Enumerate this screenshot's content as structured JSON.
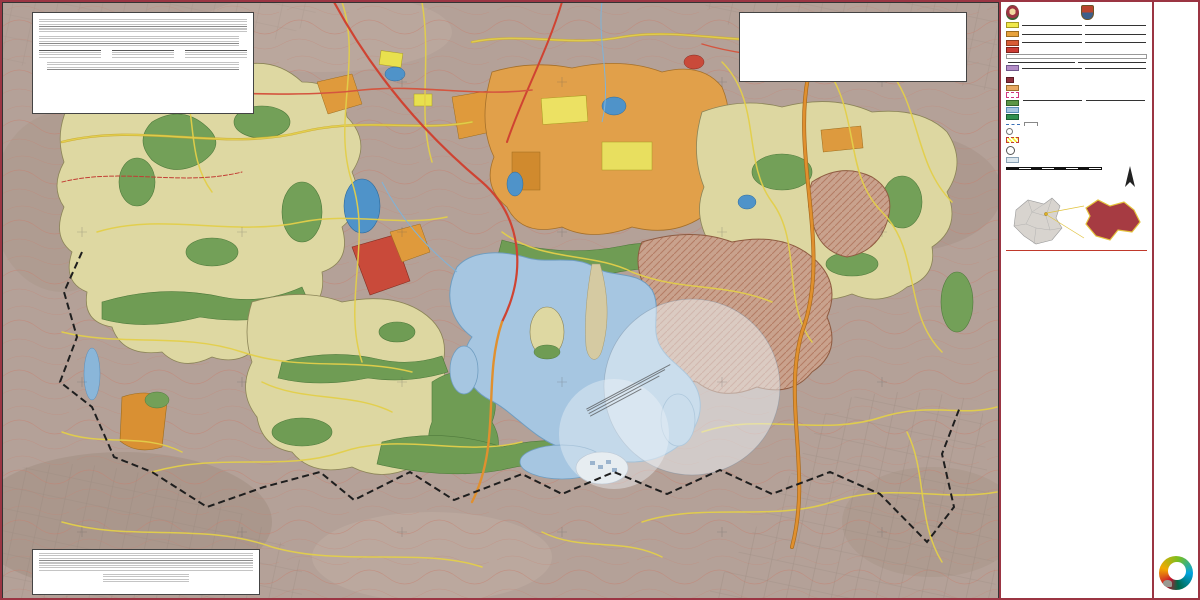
{
  "titlebar": {
    "line1": "PLAN MUNICIPAL DE DESARROLLO URBANO",
    "line2": "ATIZAPÁN DE ZARAGOZA"
  },
  "header": {
    "org1a": "Gobierno del Estado de México",
    "org1b": "Secretaría de Desarrollo Urbano y Metropolitano",
    "org2": "H. Ayuntamiento de Atizapán de Zaragoza"
  },
  "legend": {
    "title": "SIMBOLOGÍA TEMÁTICA",
    "usos_urbanos": "USOS DE SUELO URBANOS",
    "usos_no_urbanos": "USOS DE SUELO NO URBANOS",
    "hab": {
      "num": "1.",
      "title": "HABITACIONAL",
      "use": "Uso (Densidad) Habitacional",
      "note": "contención del número de niveles y la densidad",
      "code": "H-500-A",
      "example": "H-500-A",
      "codes": [
        "H-100-A",
        "H-125-A",
        "H-150-A",
        "H-167-A",
        "H-200-A",
        "H-250-A",
        "H-300-A",
        "H-333-A",
        "H-417-A",
        "H-500-A",
        "H-583-A",
        "H-667-A",
        "H-833-A",
        "H-1000-A",
        "H-1250-A",
        "H-1667-A",
        "H-2000-A",
        "H-2500-A",
        "H-5000-A",
        "H-8333-A"
      ]
    },
    "cu": {
      "num": "2.",
      "title": "CENTRO URBANO",
      "use": "Uso Centro Urbano",
      "note": "contención de niveles",
      "code": "CU-A",
      "example": "CU-A",
      "defs": "CU = CENTRO URBANO   SCU = SUB-CENTRO URBANO   CUR = CENTRO URBANO REGIONAL",
      "examples": [
        "CU-A",
        "SCU-A",
        "CUR-B"
      ]
    },
    "cru": {
      "num": "3.",
      "title": "CORREDOR URBANO",
      "use": "Uso Corredor Urbano",
      "note": "contención de niveles",
      "code": "CRU-A",
      "example": "CRU-A"
    },
    "eq": {
      "num": "4.",
      "title": "EQUIPAMIENTO COMERCIO Y SERVICIOS",
      "note": "Nota: Son los elementos destinados a prestar servicios con fines públicos o privados.",
      "subs_label": "Subsistema:",
      "items": [
        {
          "code": "E",
          "name": "Equipamiento"
        },
        {
          "code": "EC",
          "name": "Educación y Cultura"
        },
        {
          "code": "SA",
          "name": "Salud y Asistencia Social"
        },
        {
          "code": "AC",
          "name": "Abasto y Comercio"
        },
        {
          "code": "CT",
          "name": "Comunicaciones y Transportes"
        },
        {
          "code": "AP",
          "name": "Administración Pública y Servicios Urbanos"
        },
        {
          "code": "RE",
          "name": "Religioso"
        },
        {
          "code": "RD",
          "name": "Recreación y Deporte"
        }
      ],
      "example": "E-EC-M",
      "scope1": "M = Municipal",
      "scope2": "E = Estatal",
      "use": "Uso Equipamiento y Servicios",
      "code": "E-EC"
    },
    "ind": {
      "num": "5.",
      "title": "INDUSTRIA",
      "use": "Uso Industrial",
      "size_note": "Tamaño:  M = Mediana,  G = Grande",
      "code": "I-M",
      "example": "I-M",
      "def1": "I-MG-A = Industria Mixta",
      "def2": "I-MG-N = Industria Mixta, Usos Específicos y Condicionados"
    },
    "inf": {
      "num": "6.",
      "title": "INFRAESTRUCTURA",
      "code": "IF"
    },
    "pp": {
      "num": "7.",
      "title": "PLAN PARCIAL",
      "code": "PP",
      "label1": "ÁREA SUJETA A PLAN PARCIAL",
      "label2": "PLAN PARCIAL DE DESARROLLO URBANO VALLE DE PAZ"
    },
    "an": {
      "num": "8.",
      "title": "ÁREA NATURAL",
      "tip_label": "Tipología:",
      "tips": [
        "BAR = Barranca",
        "BOS = Bosque",
        "VER = Área Verde"
      ],
      "use": "Uso Natural",
      "example": "N-VER-P",
      "sit": "Situación:  P = Protegida",
      "code": "N-VER",
      "agua_code": "CA",
      "agua_label": "CUERPO DE AGUA"
    },
    "anp": {
      "num": "9.",
      "title": "ÁREA NATURAL PROTEGIDA",
      "code": "ANP"
    },
    "lim": {
      "num": "10.",
      "title": "LÍMITES",
      "l1": "LÍMITE DE SECTORES DEL TERRITORIO ADMINISTRATIVO MUNICIPAL",
      "l2": "LÍMITE DE USO DEL SUELO",
      "l3": "Radio de influencia INAH. Oficio No. 401.3(10)-2034/2019"
    },
    "conj": {
      "num": "11.",
      "title": "CONJUNTOS URBANOS Y FRACCIONAMIENTOS AUTORIZADOS",
      "label": "CONJUNTOS URBANOS Y FRACCIONAMIENTOS",
      "ref": "Referencia a Plano E2a y E2b."
    }
  },
  "basica": {
    "title": "SIMBOLOGÍA BÁSICA",
    "rows": [
      {
        "label": "LÍMITE MUNICIPAL",
        "icon": "i-limmun"
      },
      {
        "label": "TRAZA URBANA",
        "icon": "i-traza"
      },
      {
        "label": "VIALIDAD PRIMARIA",
        "icon": "i-prim"
      },
      {
        "label": "VIALIDAD PRIMARIA PREVISTA",
        "icon": "i-primprev"
      },
      {
        "label": "VIALIDAD SECUNDARIA COLECTORA",
        "icon": "i-seccol"
      },
      {
        "label": "VIALIDAD SECUNDARIA",
        "icon": "i-sec"
      },
      {
        "label": "VIALIDAD SECUNDARIA PREVISTA",
        "icon": "i-secprev"
      },
      {
        "label": "DUCTO",
        "icon": "i-ducto"
      },
      {
        "label": "LÍNEA ENERGÍA ELÉCTRICA",
        "icon": "i-elec"
      },
      {
        "label": "CURVA DE NIVEL",
        "icon": "i-curva"
      },
      {
        "label": "LÍMITE A.N.P.",
        "icon": "i-limanp"
      },
      {
        "label": "ESCURRIMIENTOS",
        "icon": "i-escurr"
      },
      {
        "label": "CUERPO DE AGUA",
        "icon": "i-agua"
      }
    ]
  },
  "inah": {
    "logo": "INAH",
    "text": "Área considerada como sitio arqueológico, de acuerdo al Oficio No. 401.1S.1-2019/0035 con fecha del 9 enero 2020, expedido por el Instituto Nacional de Antropología e Historia."
  },
  "aero": {
    "label": "ÁREA OPERATIVA DEL AERÓDROMO DOCTOR JORGE JIMÉNEZ CANTÚ"
  },
  "nota": {
    "label": "Nota:",
    "lines": [
      "Del límite del área operativa del aeródromo, los proyectos e intervenciones",
      "requieren la verificación del estado actual de la zona de interés.",
      "Se requiere el Visto Bueno de la Dirección General de Aeronáutica Civil, de",
      "acuerdo al Reglamento de la Ley de Aeropuertos, para los proyectos que se",
      "localicen dentro del área operativa del aeródromo."
    ]
  },
  "escala": {
    "label": "ESCALA:",
    "value": "1:8.000",
    "ticks": [
      "0",
      "100",
      "200",
      "300",
      "400 m"
    ]
  },
  "north": {
    "letter": "N"
  },
  "loc": {
    "label": "LOCALIZACIÓN:"
  },
  "footer": {
    "nombre_label": "NOMBRE:",
    "nombre1": "ESTRUCTURA URBANA",
    "nombre2": "Y USOS DE SUELO",
    "mapa_label": "MAPA:",
    "mapa": "E2-SVIII",
    "source": "DATUM: WGS84. PROYECCIÓN: UTM ZONA 14N. FUENTE: ELABORACIÓN PROPIA A PARTIR DE DATOS DE INEGI, SEDUYM Y EL H. AYUNTAMIENTO DE ATIZAPÁN DE ZARAGOZA."
  },
  "cert": {
    "title": "ACTA DE APROBACIÓN Y PUBLICACIÓN",
    "sig1": "NOMBRE",
    "sig2": "FECHA",
    "sig3": "SELLO"
  },
  "conjuntos_box": {
    "title": "CONJUNTOS Y FRACCIONAMIENTOS AUTORIZADOS",
    "items": [
      {
        "num": "1",
        "name": "BELLAVISTA"
      },
      {
        "num": "24",
        "name": "LA ESTADIA"
      },
      {
        "num": "25",
        "name": "LAGO ESMERALDA"
      },
      {
        "num": "41",
        "name": "RANCHO LA ESTADIA"
      }
    ]
  },
  "map": {
    "watermarks": [
      {
        "text": "DOCUMENTO NO OFICIAL",
        "x": 300,
        "y": 224,
        "rot": -32,
        "size": 38
      },
      {
        "text": "DOCUMENTO NO OFICIAL",
        "x": 788,
        "y": 424,
        "rot": -38,
        "size": 27
      }
    ],
    "labels": [
      {
        "text": "CUR",
        "x": 518,
        "y": 163,
        "rot": -90,
        "cls": "lbl-zone"
      },
      {
        "text": "CUR",
        "x": 544,
        "y": 150,
        "rot": -90,
        "cls": "lbl-zone"
      },
      {
        "text": "CUR",
        "x": 568,
        "y": 158,
        "rot": -90,
        "cls": "lbl-zone"
      },
      {
        "text": "CUR",
        "x": 586,
        "y": 126,
        "rot": -90,
        "cls": "lbl-zone"
      },
      {
        "text": "CUR",
        "x": 543,
        "y": 103,
        "rot": 0,
        "cls": "lbl-zone"
      },
      {
        "text": "CUR",
        "x": 611,
        "y": 186,
        "rot": 0,
        "cls": "lbl-zone"
      },
      {
        "text": "CUR",
        "x": 646,
        "y": 128,
        "rot": 0,
        "cls": "lbl-zone"
      },
      {
        "text": "CUR",
        "x": 688,
        "y": 174,
        "rot": 0,
        "cls": "lbl-zone"
      },
      {
        "text": "CUR",
        "x": 606,
        "y": 214,
        "rot": 0,
        "cls": "lbl-zone"
      },
      {
        "text": "E",
        "x": 597,
        "y": 147,
        "rot": -90,
        "cls": "lbl-zone-sm"
      },
      {
        "text": "E-RD",
        "x": 789,
        "y": 127,
        "rot": -80,
        "cls": "lbl-zone-sm"
      },
      {
        "text": "CRU-B",
        "x": 400,
        "y": 238,
        "rot": 0,
        "cls": "lbl-zone"
      },
      {
        "text": "CRU-B",
        "x": 414,
        "y": 269,
        "rot": 0,
        "cls": "lbl-zone"
      },
      {
        "text": "H-8333-A",
        "x": 122,
        "y": 329,
        "rot": -8,
        "cls": "lbl-zone"
      },
      {
        "text": "H-8333-A",
        "x": 128,
        "y": 354,
        "rot": -8,
        "cls": "lbl-zone"
      },
      {
        "text": "N-BAR",
        "x": 128,
        "y": 374,
        "rot": -5,
        "cls": "lbl-zone"
      },
      {
        "text": "N-BAR",
        "x": 358,
        "y": 359,
        "rot": -55,
        "cls": "lbl-zone-sm"
      },
      {
        "text": "N-BAR",
        "x": 407,
        "y": 448,
        "rot": 0,
        "cls": "lbl-zone-sm"
      },
      {
        "text": "N-BAR",
        "x": 496,
        "y": 408,
        "rot": -40,
        "cls": "lbl-zone-sm"
      },
      {
        "text": "N-BAR",
        "x": 546,
        "y": 438,
        "rot": 0,
        "cls": "lbl-zone-sm"
      },
      {
        "text": "N-BAR",
        "x": 689,
        "y": 357,
        "rot": -70,
        "cls": "lbl-zone-sm"
      },
      {
        "text": "N-BAR",
        "x": 796,
        "y": 268,
        "rot": -70,
        "cls": "lbl-zone-sm"
      },
      {
        "text": "PLAN PARCIAL",
        "x": 765,
        "y": 141,
        "rot": -55,
        "cls": "lbl-pp"
      },
      {
        "text": "PLAN PARCIAL",
        "x": 815,
        "y": 206,
        "rot": -75,
        "cls": "lbl-pp"
      },
      {
        "text": "PLAN PARCIAL",
        "x": 732,
        "y": 263,
        "rot": -80,
        "cls": "lbl-pp"
      },
      {
        "text": "PLAN PARCIAL",
        "x": 700,
        "y": 330,
        "rot": -60,
        "cls": "lbl-pp"
      },
      {
        "text": "PLAN PARCIAL",
        "x": 274,
        "y": 324,
        "rot": 0,
        "cls": "lbl-pp"
      },
      {
        "text": "PLAN PARCIAL",
        "x": 330,
        "y": 352,
        "rot": -90,
        "cls": "lbl-pp"
      },
      {
        "text": "PLAN PARCIAL",
        "x": 297,
        "y": 390,
        "rot": -40,
        "cls": "lbl-pp"
      },
      {
        "text": "PLAN PARCIAL",
        "x": 352,
        "y": 422,
        "rot": 0,
        "cls": "lbl-pp"
      },
      {
        "text": "PLAN PARCIAL",
        "x": 391,
        "y": 432,
        "rot": 0,
        "cls": "lbl-pp"
      },
      {
        "text": "CA",
        "x": 592,
        "y": 372,
        "rot": -60,
        "cls": "lbl-water"
      },
      {
        "text": "NAUCALPAN",
        "x": 512,
        "y": 487,
        "rot": 0,
        "cls": "lbl-muni"
      },
      {
        "text": "DE JUÁREZ",
        "x": 512,
        "y": 503,
        "rot": 0,
        "cls": "lbl-muni"
      },
      {
        "text": "TLALNEPANTLA",
        "x": 856,
        "y": 570,
        "rot": 0,
        "cls": "lbl-muni-sm"
      },
      {
        "text": "DE BAZ",
        "x": 856,
        "y": 584,
        "rot": 0,
        "cls": "lbl-muni-sm"
      }
    ],
    "markers": [
      {
        "num": "1",
        "x": 204,
        "y": 96
      },
      {
        "num": "24",
        "x": 468,
        "y": 332
      },
      {
        "num": "25",
        "x": 598,
        "y": 468
      },
      {
        "num": "41",
        "x": 520,
        "y": 300
      }
    ],
    "coords_bottom": [
      {
        "text": "464000",
        "x": 150,
        "y": 590
      },
      {
        "text": "466000",
        "x": 310,
        "y": 590
      },
      {
        "text": "468000",
        "x": 470,
        "y": 590
      },
      {
        "text": "470000",
        "x": 630,
        "y": 590
      },
      {
        "text": "472000",
        "x": 790,
        "y": 590
      },
      {
        "text": "474000",
        "x": 935,
        "y": 590
      }
    ],
    "coords_left": [
      {
        "text": "2162000",
        "x": 7,
        "y": 120
      },
      {
        "text": "2160000",
        "x": 7,
        "y": 300
      },
      {
        "text": "2158000",
        "x": 7,
        "y": 465
      }
    ]
  },
  "colors": {
    "frame": "#9b3543",
    "title_text": "#9e3e4f",
    "watermark": "#cd4637",
    "habitacional": "#f0e84a",
    "centro_urbano": "#e8a33d",
    "corredor": "#d85c35",
    "equipamiento": "#cc3b33",
    "industria": "#b48ec8",
    "natural": "#6f9c54",
    "agua": "#a6c6e1",
    "terreno": "#b4a198"
  }
}
